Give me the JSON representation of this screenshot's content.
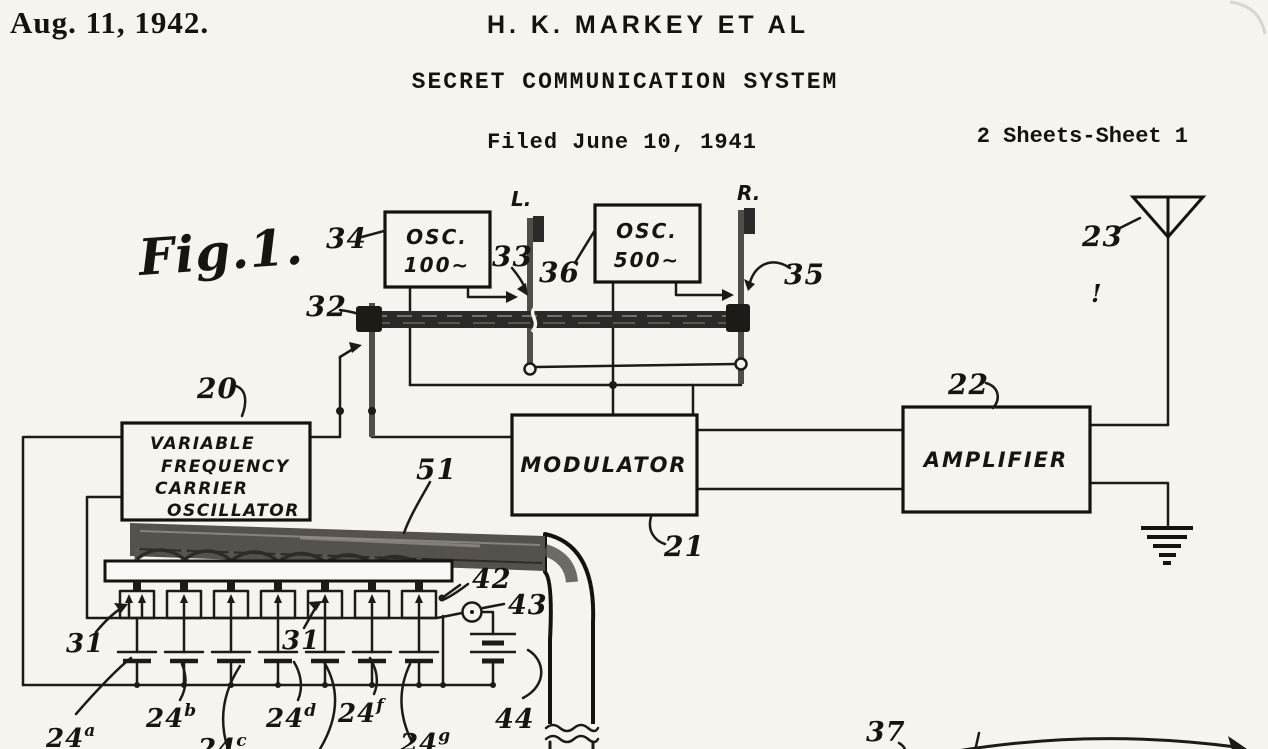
{
  "header": {
    "date": "Aug. 11, 1942.",
    "inventor": "H. K. MARKEY ET AL",
    "doc_title": "SECRET COMMUNICATION SYSTEM",
    "filed": "Filed June 10, 1941",
    "sheet": "2 Sheets-Sheet 1"
  },
  "figure": {
    "fig_label": "Fig.1.",
    "blocks": {
      "osc100": {
        "line1": "OSC.",
        "line2": "100∼"
      },
      "osc500": {
        "line1": "OSC.",
        "line2": "500∼"
      },
      "vfo": {
        "line1": "VARIABLE",
        "line2": "FREQUENCY",
        "line3": "CARRIER",
        "line4": "OSCILLATOR"
      },
      "modulator": {
        "label": "MODULATOR"
      },
      "amplifier": {
        "label": "AMPLIFIER"
      }
    },
    "rods": {
      "left": "L.",
      "right": "R."
    },
    "refs": {
      "n20": "20",
      "n21": "21",
      "n22": "22",
      "n23": "23",
      "n31_left": "31",
      "n31_right": "31",
      "n32": "32",
      "n33": "33",
      "n34": "34",
      "n35": "35",
      "n36": "36",
      "n37": "37",
      "n42": "42",
      "n43": "43",
      "n44": "44",
      "n51": "51",
      "exclaim": "!"
    },
    "capacitors": [
      {
        "base": "24",
        "sup": "a"
      },
      {
        "base": "24",
        "sup": "b"
      },
      {
        "base": "24",
        "sup": "c"
      },
      {
        "base": "24",
        "sup": "d"
      },
      {
        "base": "24",
        "sup": "f"
      },
      {
        "base": "24",
        "sup": "g"
      }
    ]
  },
  "colors": {
    "ink": "#1d1b18",
    "paper": "#f6f4ef",
    "rod_gray": "#514e49",
    "band_gray": "#55524e"
  }
}
